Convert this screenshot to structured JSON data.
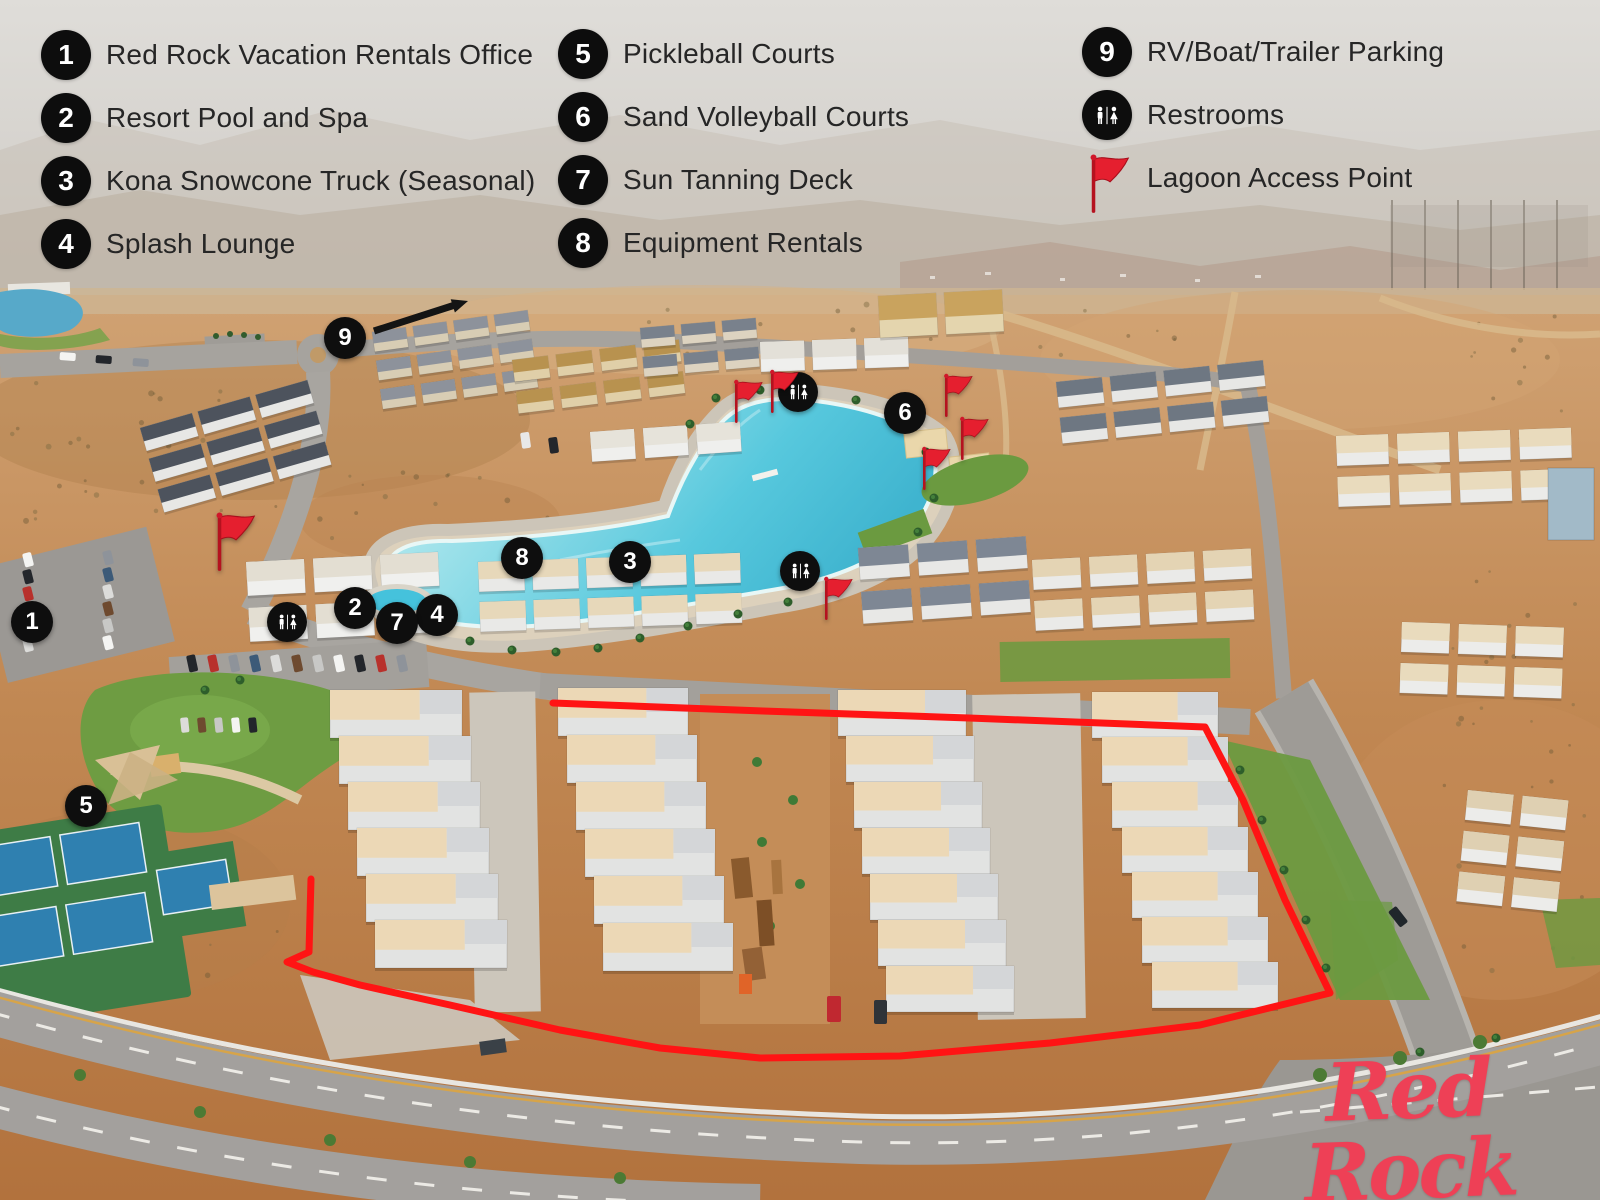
{
  "legend": {
    "columns": [
      {
        "items": [
          {
            "num": "1",
            "label": "Red Rock Vacation Rentals Office"
          },
          {
            "num": "2",
            "label": "Resort Pool and Spa"
          },
          {
            "num": "3",
            "label": "Kona Snowcone Truck (Seasonal)"
          },
          {
            "num": "4",
            "label": "Splash Lounge"
          }
        ]
      },
      {
        "items": [
          {
            "num": "5",
            "label": "Pickleball Courts"
          },
          {
            "num": "6",
            "label": "Sand Volleyball Courts"
          },
          {
            "num": "7",
            "label": "Sun Tanning Deck"
          },
          {
            "num": "8",
            "label": "Equipment Rentals"
          }
        ]
      },
      {
        "items": [
          {
            "num": "9",
            "label": "RV/Boat/Trailer Parking"
          },
          {
            "icon": "restrooms",
            "label": "Restrooms"
          },
          {
            "icon": "lagoon-flag",
            "label": "Lagoon Access Point"
          }
        ]
      }
    ]
  },
  "map": {
    "numbered_markers": [
      {
        "num": "1",
        "x": 32,
        "y": 622
      },
      {
        "num": "2",
        "x": 355,
        "y": 608
      },
      {
        "num": "3",
        "x": 630,
        "y": 562
      },
      {
        "num": "4",
        "x": 437,
        "y": 615
      },
      {
        "num": "5",
        "x": 86,
        "y": 806
      },
      {
        "num": "6",
        "x": 905,
        "y": 413
      },
      {
        "num": "7",
        "x": 397,
        "y": 623
      },
      {
        "num": "8",
        "x": 522,
        "y": 558
      },
      {
        "num": "9",
        "x": 345,
        "y": 338
      }
    ],
    "restroom_markers": [
      {
        "x": 798,
        "y": 392
      },
      {
        "x": 287,
        "y": 622
      },
      {
        "x": 800,
        "y": 571
      }
    ],
    "flag_markers": [
      {
        "x": 218,
        "y": 520,
        "size": 1.35
      },
      {
        "x": 737,
        "y": 388,
        "size": 1
      },
      {
        "x": 773,
        "y": 378,
        "size": 1
      },
      {
        "x": 947,
        "y": 382,
        "size": 1
      },
      {
        "x": 963,
        "y": 425,
        "size": 1
      },
      {
        "x": 925,
        "y": 455,
        "size": 1
      },
      {
        "x": 827,
        "y": 585,
        "size": 1
      }
    ],
    "property_outline_points": "553,703 763,711 969,718 1205,727 1243,800 1285,900 1330,993 1200,1025 1050,1043 900,1056 760,1058 660,1048 560,1030 450,1005 360,985 313,972 287,962 309,952 311,879",
    "colors": {
      "outline": "#ff1414",
      "flag": "#e51f2f",
      "marker_bg": "#0e0e0e"
    }
  },
  "logo": {
    "name": "Red Rock",
    "subtext": "VACATION RENTALS",
    "trademark": "®"
  }
}
